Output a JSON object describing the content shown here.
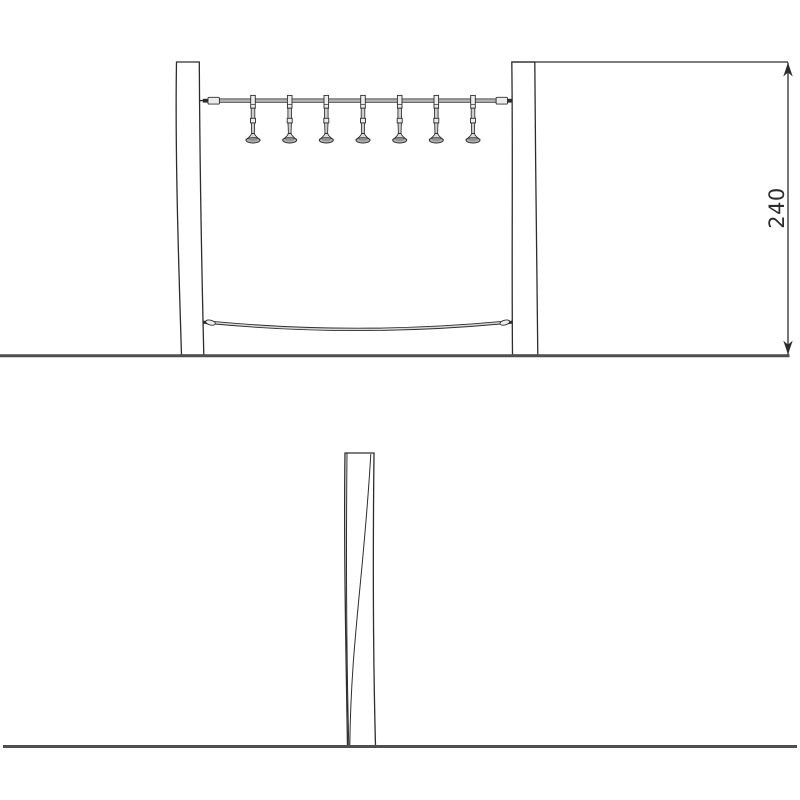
{
  "dimension": {
    "label": "240"
  },
  "colors": {
    "ink": "#2d2d2d",
    "ground": "#4f4f4f",
    "cable": "#b5b5b5",
    "metal": "#ececec",
    "rope": "#d8d8d8",
    "bell": "#b0b0b0"
  },
  "front_view": {
    "hanger_count": 7,
    "hanger_x": [
      253,
      289.7,
      326.3,
      363,
      399.7,
      436.3,
      473
    ]
  }
}
